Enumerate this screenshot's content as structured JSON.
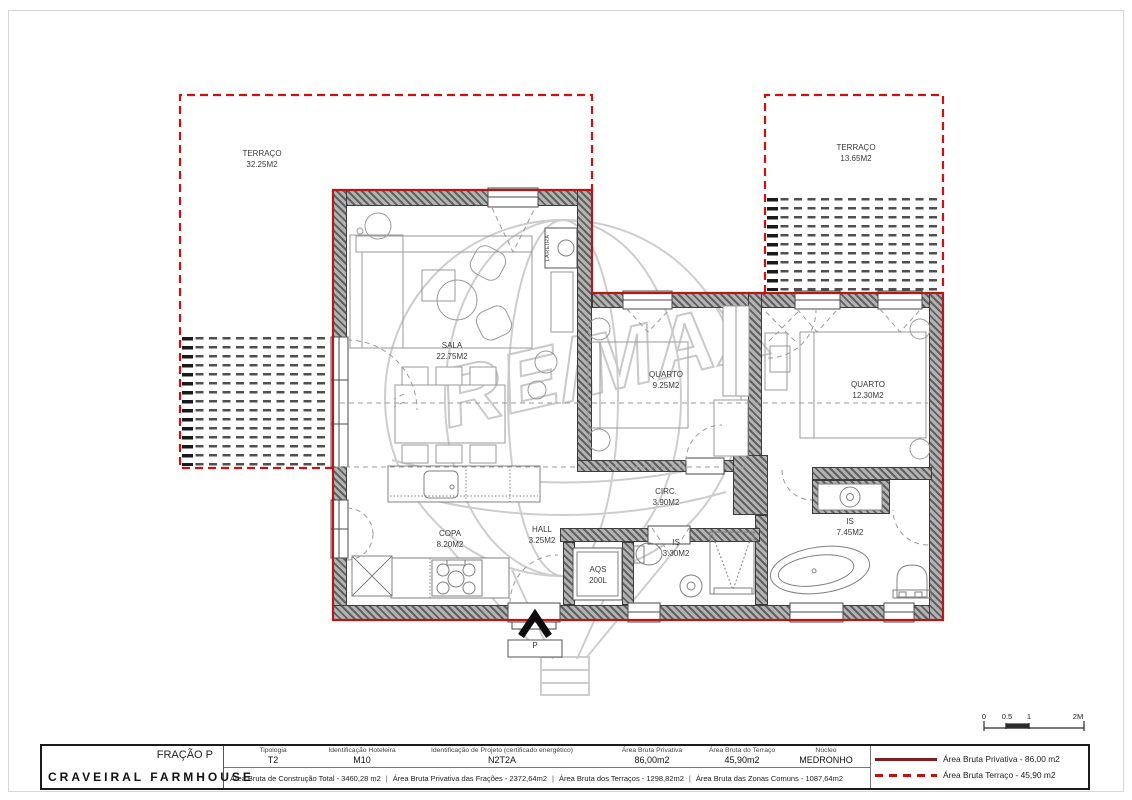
{
  "drawing": {
    "watermark_text": "RE/MAX",
    "entrance_label": "P",
    "fireplace_label": "LAREIRA"
  },
  "rooms": [
    {
      "id": "terraco-left",
      "name": "TERRAÇO",
      "area": "32.25M2"
    },
    {
      "id": "terraco-right",
      "name": "TERRAÇO",
      "area": "13.65M2"
    },
    {
      "id": "sala",
      "name": "SALA",
      "area": "22.75M2"
    },
    {
      "id": "quarto-1",
      "name": "QUARTO",
      "area": "9.25M2"
    },
    {
      "id": "quarto-2",
      "name": "QUARTO",
      "area": "12.30M2"
    },
    {
      "id": "circ",
      "name": "CIRC.",
      "area": "3.90M2"
    },
    {
      "id": "copa",
      "name": "COPA",
      "area": "8.20M2"
    },
    {
      "id": "hall",
      "name": "HALL",
      "area": "3.25M2"
    },
    {
      "id": "is-1",
      "name": "IS",
      "area": "3.30M2"
    },
    {
      "id": "is-2",
      "name": "IS",
      "area": "7.45M2"
    },
    {
      "id": "aqs",
      "name": "AQS",
      "area": "200L"
    }
  ],
  "title_block": {
    "fraction": "FRAÇÃO P",
    "project_name": "CRAVEIRAL FARMHOUSE",
    "fields": [
      {
        "label": "Tipologia",
        "value": "T2"
      },
      {
        "label": "Identificação Hoteleira",
        "value": "M10"
      },
      {
        "label": "Identificação de Projeto (certificado energético)",
        "value": "N2T2A"
      },
      {
        "label": "Área Bruta Privativa",
        "value": "86,00m2"
      },
      {
        "label": "Área Bruta do Terraço",
        "value": "45,90m2"
      },
      {
        "label": "Núcleo",
        "value": "MEDRONHO"
      }
    ],
    "totals": [
      "Área Bruta de Construção Total - 3460,28 m2",
      "Área Bruta Privativa das Frações - 2372,64m2",
      "Área Bruta dos Terraços - 1298,82m2",
      "Área Bruta das Zonas Comuns - 1087,64m2"
    ]
  },
  "legend": {
    "solid": {
      "label": "Área Bruta Privativa - 86,00 m2",
      "color": "#7d1d1d"
    },
    "dashed": {
      "label": "Área Bruta Terraço  - 45,90 m2",
      "color": "#c31111"
    }
  },
  "scale_bar": {
    "ticks": [
      "0",
      "0.5",
      "1",
      "2M"
    ]
  },
  "colors": {
    "privative_outline": "#b41818",
    "terrace_dashed": "#cc1111"
  }
}
